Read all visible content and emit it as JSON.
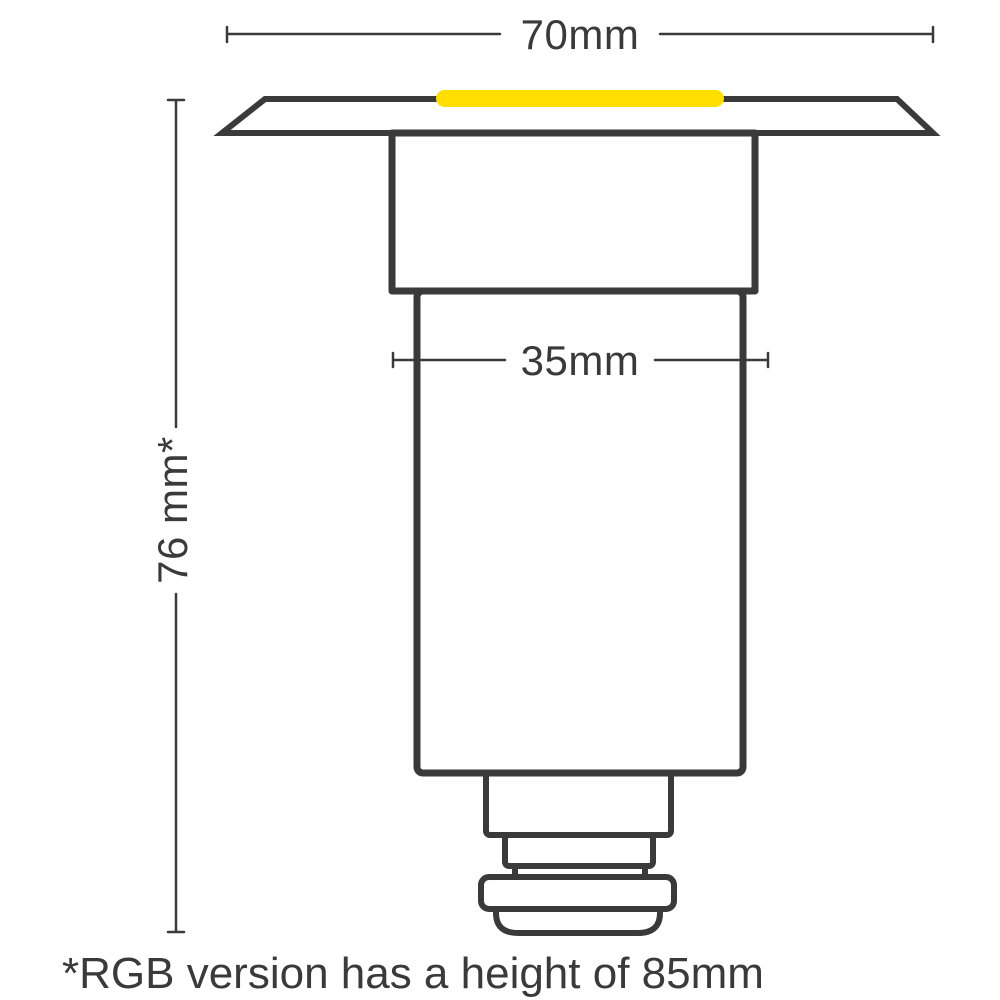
{
  "diagram": {
    "labels": {
      "top_width": "70mm",
      "body_width": "35mm",
      "height": "76 mm*",
      "footnote": "*RGB version has a height of 85mm"
    },
    "colors": {
      "line": "#3a3a3a",
      "text": "#3a3a3a",
      "led": "#ffde00",
      "background": "#ffffff"
    }
  }
}
